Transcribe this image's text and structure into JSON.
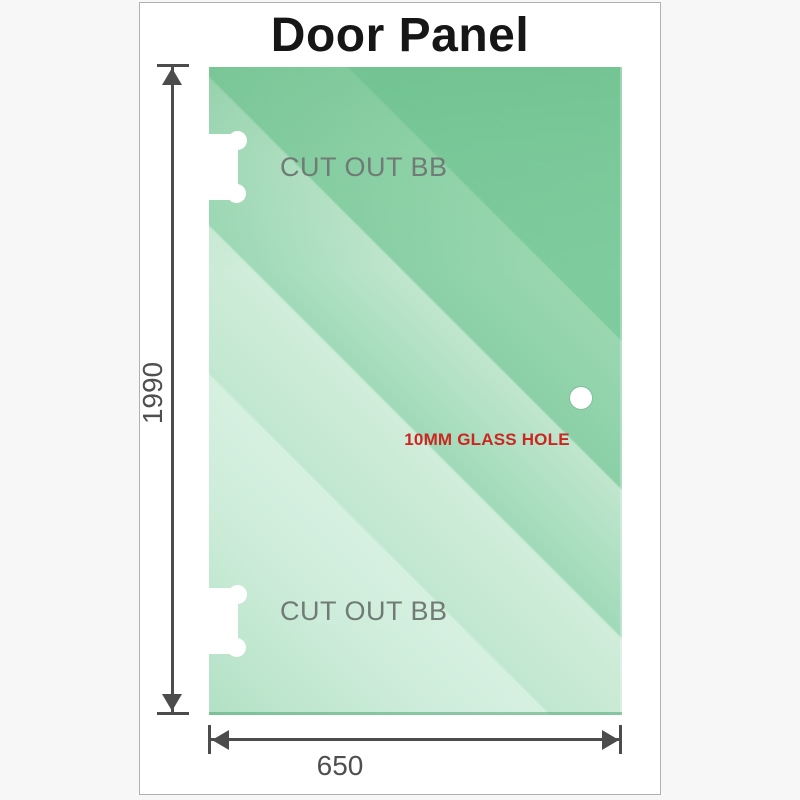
{
  "title": "Door Panel",
  "panel": {
    "cutouts": [
      {
        "position": "top",
        "label": "CUT OUT BB"
      },
      {
        "position": "bottom",
        "label": "CUT OUT BB"
      }
    ],
    "glass_hole_label": "10MM GLASS HOLE"
  },
  "dimensions": {
    "height": "1990",
    "width": "650"
  },
  "colors": {
    "glass_dark": "#7ecb9d",
    "glass_light": "#d6f0e0",
    "dim": "#4c4c4c",
    "num_gray": "#4f4f4f",
    "cut_gray": "#6f7b74",
    "red": "#cc2620",
    "card_border": "#b0b0b0",
    "title_color": "#161616"
  }
}
